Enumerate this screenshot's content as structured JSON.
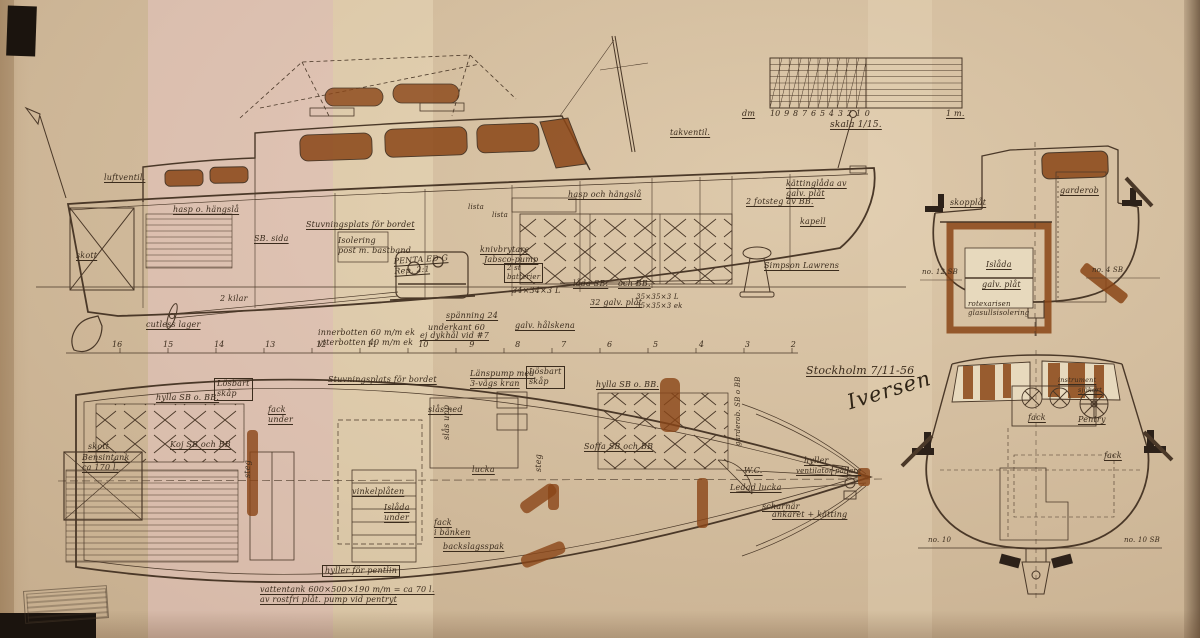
{
  "colors": {
    "ink": "#4a3828",
    "stain": "#8a4516",
    "paper": "#d8c2a3"
  },
  "labels": {
    "side": {
      "luftventil": "luftventil.",
      "takventil": "takventil.",
      "hasp_aft": "hasp o. hängslå",
      "hasp_fwd": "hasp och hängslå",
      "sb_sida": "SB. sida",
      "stuvningsplats": "Stuvningsplats för bordet",
      "isolering": "Isolering\npost m. bastband",
      "motor": "PENTA ED G\nRep. 2:1",
      "knivbrytare": "knivbrytare",
      "jabsco": "Jabsco-pump",
      "batterier": "2 st\nbatterier",
      "bank_dim": "34×34×3 L",
      "lada_sb": "låda SB.",
      "och_bb": "och BB.",
      "galv_plat": "32 galv. plåt",
      "profil": "35×35×3 L\n35×35×3 ek",
      "spanning": "spänning 24",
      "underkant": "underkant 60",
      "dykhal": "ej dykhål vid #7",
      "halskena": "galv. hålskena",
      "innerbotten": "innerbotten 60 m/m ek\nytterbotten 40 m/m ek",
      "cutless": "cutless lager",
      "kilar": "2 kilar",
      "skott": "skott",
      "lista1": "lista",
      "lista2": "lista",
      "kattinglada": "kättinglåda av\ngalv. plåt",
      "fotsteg": "2 fotsteg av BB.",
      "kapell": "kapell",
      "simpson": "Simpson Lawrens",
      "stations": [
        "16",
        "15",
        "14",
        "13",
        "12",
        "11",
        "10",
        "9",
        "8",
        "7",
        "6",
        "5",
        "4",
        "3",
        "2"
      ]
    },
    "plan": {
      "hylla_left": "hylla SB o. BB.",
      "losbart1": "Lösbart\nskåp",
      "fack_under": "fack\nunder",
      "koj": "Koj SB och BB",
      "skott": "skott",
      "bensintank": "Bensintank\nca 170 l.",
      "steg1": "steg",
      "stuvningsplats": "Stuvningsplats för bordet",
      "lanspump": "Länspump med\n3-vägs kran",
      "losbart2": "Lösbart\nskåp",
      "hylla_right": "hylla SB o. BB.",
      "slas_ned": "slås ned",
      "slas_upp": "slås upp",
      "soffa": "Soffa SB och BB",
      "lucka": "lucka",
      "steg2": "steg",
      "fack_banken": "fack\ni bänken",
      "backslag": "backslagsspak",
      "vinkel": "vinkelplåten",
      "islada_under": "Islåda\nunder",
      "wc": "W.C.",
      "ledad": "Ledad lucka",
      "hyller": "hyller",
      "ventilator": "ventilator-pållare",
      "scharnar": "scharnär",
      "ankaret": "ankaret + kätting",
      "garderob_vert": "garderob. SB o BB",
      "hyller_pentlin": "hyller för pentlin",
      "vattentank": "vattentank 600×500×190 m/m = ca 70 l.\nav rostfri plåt. pump vid pentryt",
      "stockholm": "Stockholm 7/11-56",
      "signature": "Iversen"
    },
    "sections": {
      "skopplat": "skopplåt",
      "islada": "Islåda",
      "galv_plat": "galv. plåt",
      "isolering": "rotexarisen\nglasullsisolering",
      "garderob": "garderob",
      "no12": "no. 12 SB",
      "no4": "no. 4 SB",
      "instrument": "instrument",
      "sjokort": "sjökort",
      "fack1": "fack",
      "pentry": "Pentry",
      "fack2": "fack",
      "no10": "no. 10",
      "no10sb": "no. 10 SB"
    },
    "scale": {
      "dm": "dm",
      "digits": [
        "10",
        "9",
        "8",
        "7",
        "6",
        "5",
        "4",
        "3",
        "2",
        "1",
        "0"
      ],
      "one_m": "1 m.",
      "skala": "skala 1/15."
    },
    "title_block": {
      "ritning": "Ritning nr. 937",
      "boat": "8.50 × 2.40 m. Dubb. ruffad Motorbåt",
      "lvl_label": "L.V.L.",
      "lvl_value": "7.83 m.",
      "djupg_label": "Djupg.",
      "djupg_value": "0.60 —",
      "depl_label": "Depl.",
      "depl_value": "ca 2.50 m³"
    },
    "footer": {
      "copyright": "copyright: Ing. Jac. M. Iversen, Stockholm."
    }
  }
}
